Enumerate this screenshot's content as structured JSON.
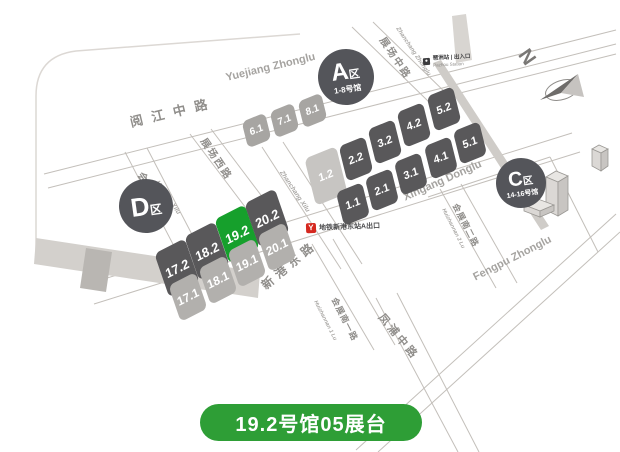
{
  "map": {
    "highlight": {
      "hall": "19.2",
      "badge_label": "19.2号馆05展台"
    },
    "halls": [
      "6.1",
      "7.1",
      "8.1",
      "1.2",
      "2.2",
      "3.2",
      "4.2",
      "5.2",
      "1.1",
      "2.1",
      "3.1",
      "4.1",
      "5.1",
      "17.2",
      "18.2",
      "19.2",
      "20.2",
      "17.1",
      "18.1",
      "19.1",
      "20.1"
    ],
    "areas": {
      "a": {
        "letter": "A",
        "suffix": "区",
        "halls_range": "1-8号馆"
      },
      "c": {
        "letter": "C",
        "suffix": "区",
        "halls_range": "14-16号馆"
      },
      "d": {
        "letter": "D",
        "suffix": "区"
      }
    },
    "roads": {
      "yuejiang_cn": "阅江中路",
      "yuejiang_en": "Yuejiang Zhonglu",
      "zhanchang_zhonglu_cn": "展场中路",
      "zhanchang_zhonglu_en": "Zhanchang Zhonglu",
      "zhanchang_xilu_cn": "展场西路",
      "zhanchang_xilu_en": "Zhanchang Xilu",
      "huizhan_xilu_cn": "会展西路",
      "huizhan_xilu_en": "Huizhan Xilu",
      "xingang_cn": "新港东路",
      "xingang_en": "Xingang Donglu",
      "huizhannan1_cn": "会展南一路",
      "huizhannan1_en": "Huizhannan 1 Lu",
      "huizhannan2_cn": "会展南二路",
      "huizhannan2_en": "Huizhannan 2 Lu",
      "fengpu_cn": "凤浦中路",
      "fengpu_en": "Fengpu Zhonglu"
    },
    "landmarks": {
      "metro_exit_label": "地铁新港东站A出口",
      "metro_logo_glyph": "Y",
      "station_label": "琶洲站 | 出入口",
      "station_sublabel": "Pazhou Station",
      "compass_n": "N"
    }
  },
  "colors": {
    "hall_dark": "#59585a",
    "hall_light": "#b2b0ad",
    "hall_lighter": "#c7c5c2",
    "hall_mid": "#a7a5a2",
    "hall_green": "#16a02c",
    "badge_green": "#2e9e36",
    "zone_circle": "#54555a",
    "metro_red": "#d5281f"
  }
}
